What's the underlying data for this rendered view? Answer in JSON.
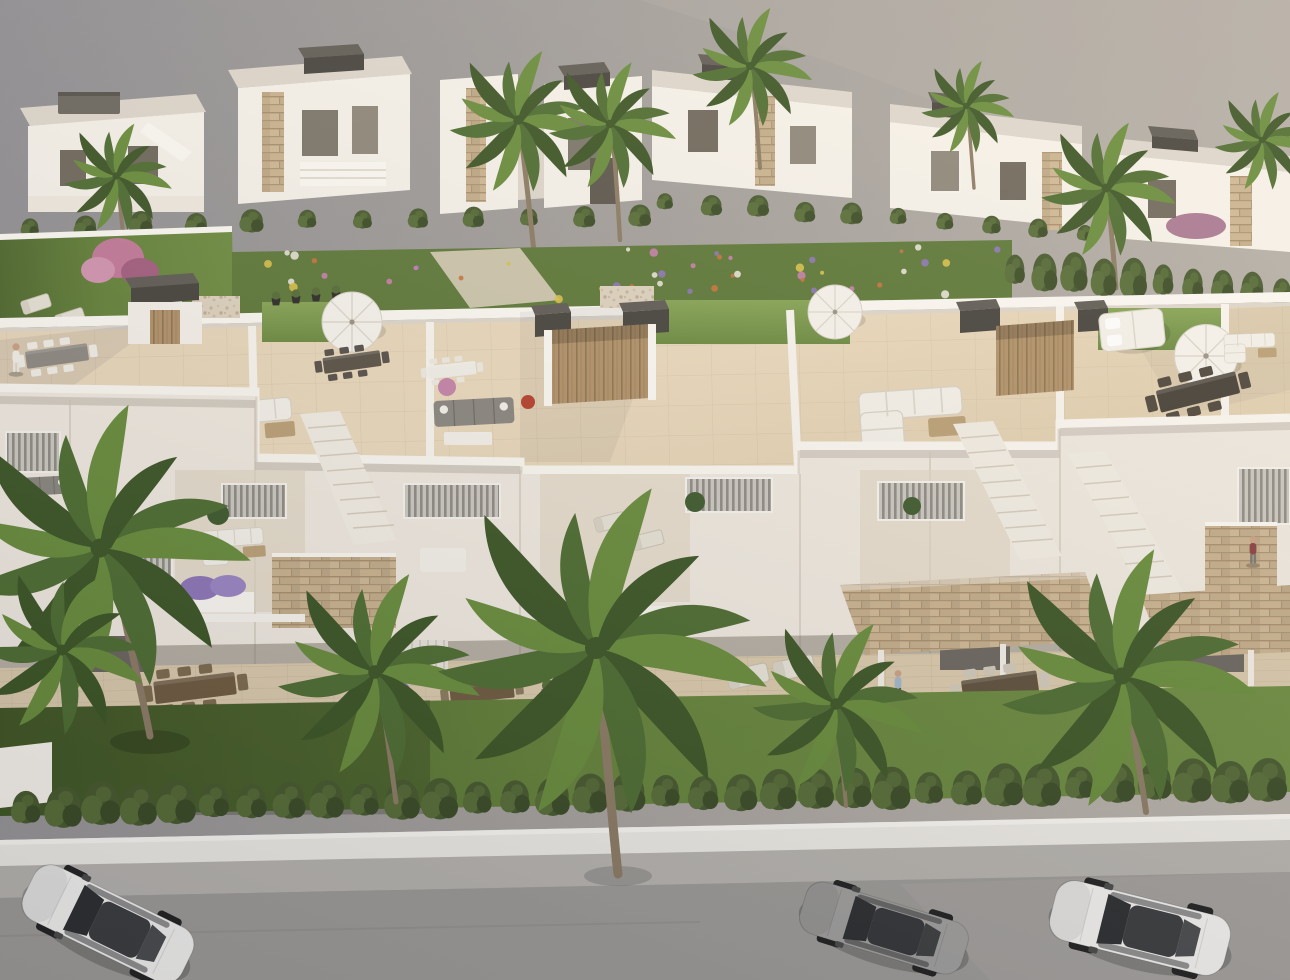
{
  "scene": {
    "type": "architectural-3d-render",
    "description": "High-angle aerial 3D visualization of a modern Mediterranean residential development: two rows of white flat-roof townhouses with rooftop solarium terraces, outdoor furniture, landscaped gardens with palm trees, a front lawn with hedge, white boundary wall, sidewalk and asphalt street with three parked cars",
    "time_of_day": "daytime",
    "camera": "elevated aerial three-quarter view"
  },
  "palette": {
    "bg_l": "#8f8e93",
    "bg_m": "#a29e9b",
    "bg_r": "#b4aea7",
    "wall": "#f5f1ea",
    "wall_2": "#efe9e0",
    "wall_sh": "#ddd6cc",
    "wall_dk": "#c8c1b6",
    "parapet": "#fbf8f3",
    "roof_floor": "#ead9bd",
    "roof_floor_2": "#dfcdab",
    "tile_line": "#cbbb9c",
    "grass_1": "#86a455",
    "grass_2": "#6a8a40",
    "lawn_1": "#6d8c41",
    "lawn_2": "#4e682e",
    "hedge_1": "#46592e",
    "hedge_2": "#566c37",
    "hedge_3": "#3a4b26",
    "palm_1": "#4d6c31",
    "palm_2": "#688c3c",
    "palm_3": "#3c5526",
    "trunk": "#8b7b64",
    "stone_1": "#c6b190",
    "stone_2": "#ab9372",
    "wood_1": "#b69a6f",
    "wood_2": "#9a7f57",
    "dark_box_1": "#5f5b55",
    "dark_box_2": "#46433e",
    "dark_box_3": "#353330",
    "furn_dark": "#4c453c",
    "furn_gray": "#8a8680",
    "furn_white": "#f4f1ea",
    "glass": "#2c2e30",
    "street": "#9d9b97",
    "sidewalk": "#b6b3ae",
    "front_wall": "#eceae4",
    "car_white": "#f2f1ee",
    "car_gray": "#a09f9d",
    "skin": "#c9a184",
    "tree_pink": "#c2799a"
  },
  "back_villas": {
    "style": "white flat-roof villas with dark rooftop caps, stone-clad pillars and hedged gardens",
    "count": 6,
    "hedge_bush_counts": [
      12,
      10,
      10
    ]
  },
  "courtyard_garden": {
    "features": [
      "lawn",
      "pink flowering tree",
      "flower beds",
      "gravel path",
      "cypress hedge"
    ],
    "flower_count": 48,
    "flower_colors": [
      "#c77fae",
      "#e8e4da",
      "#c8723c",
      "#8d76b8",
      "#d9c04a"
    ]
  },
  "main_block": {
    "roof_terraces": {
      "floor": "cream tile",
      "grass_patches": 3,
      "stair_bulkheads": 3,
      "furniture": [
        "white corner sofas",
        "gray sofa",
        "dining sets with chairs",
        "long dark dining table",
        "white parasols",
        "double daybed",
        "planter pots",
        "flower planters"
      ]
    },
    "balcony_level": {
      "features": [
        "louvered shutters",
        "stone-clad panels",
        "white balustrades",
        "lavender planters",
        "descending staircases",
        "potted plants"
      ]
    },
    "ground_level": {
      "features": [
        "covered terraces",
        "wood dining sets",
        "sun loungers",
        "stone canopies",
        "glass doors"
      ]
    }
  },
  "front_garden": {
    "lawn": true,
    "hedge_bush_count": 34,
    "boundary_wall": "white"
  },
  "street": {
    "sidewalk": "textured light gray",
    "road": "asphalt gray",
    "cars": [
      {
        "name": "white-suv",
        "color": "#f2f1ee",
        "position": "left",
        "heading": "down-left"
      },
      {
        "name": "gray-coupe",
        "color": "#a09f9d",
        "position": "center-right",
        "heading": "left"
      },
      {
        "name": "white-sedan",
        "color": "#f3f2f0",
        "position": "right",
        "heading": "left"
      }
    ]
  },
  "people": [
    {
      "location": "left rooftop terrace",
      "shirt": "#f2efe9",
      "pants": "#eceae2"
    },
    {
      "location": "right balcony terrace",
      "shirt": "#8a4040",
      "pants": "#777672"
    },
    {
      "location": "ground floor terrace",
      "shirt": "#9fb6c8",
      "pants": "#4e4c48"
    }
  ],
  "vegetation": {
    "palm_fronds_per_head": 12,
    "foreground_palms": 5,
    "background_palms": 7
  }
}
